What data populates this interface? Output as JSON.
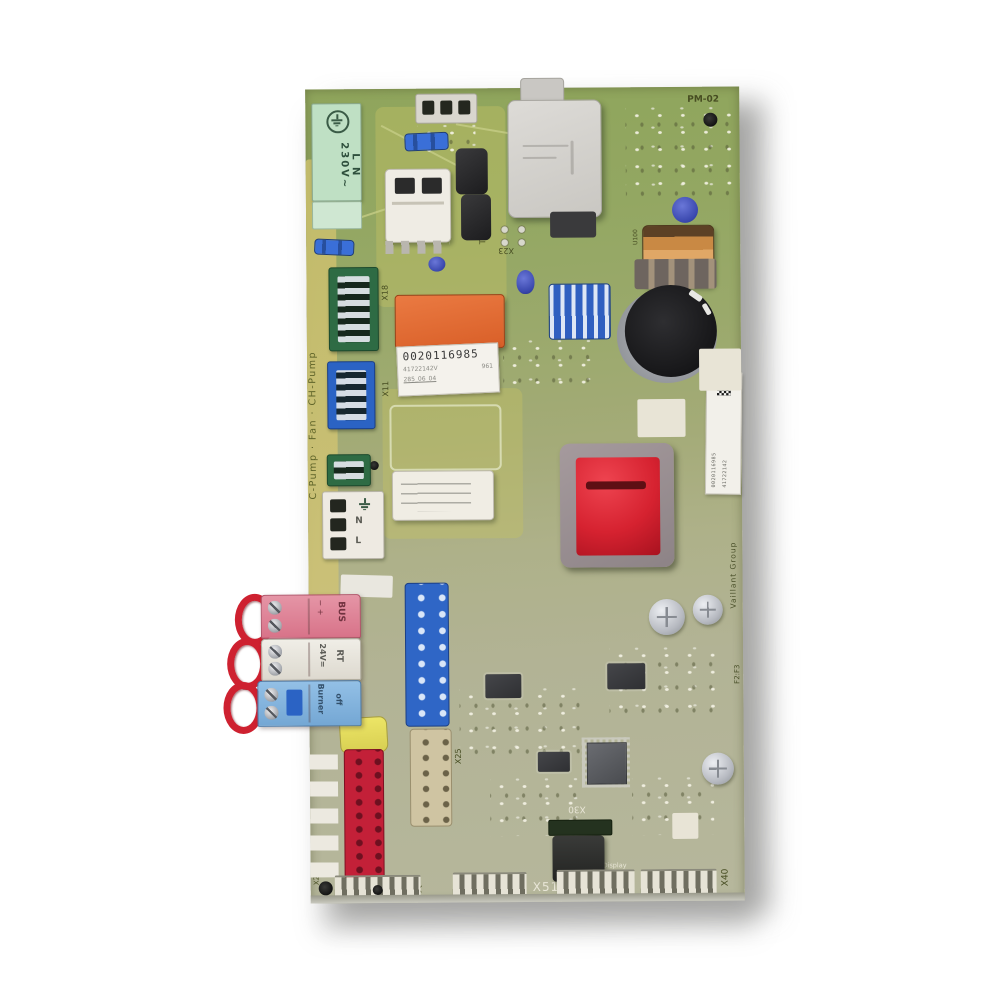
{
  "photo": {
    "subject": "Vaillant boiler control circuit board photographed on white background"
  },
  "colors": {
    "board_top": "#8fa55c",
    "board_bottom": "#b6b79c",
    "relay_orange": "#e06f38",
    "transformer_red": "#d62230",
    "connector_pink": "#e08a9b",
    "connector_blue": "#86b5de",
    "header_blue": "#2f66c6",
    "header_red": "#c32038",
    "mains_green": "#bfe0c4"
  },
  "silkscreen": {
    "pm02": "PM-02",
    "code_0914": "0914",
    "t2": "T2",
    "x23": "X23",
    "x18": "X18",
    "x11": "X11",
    "u100": "U100",
    "x25": "X25",
    "x24": "X24",
    "x21": "X21",
    "x51": "X51",
    "x30": "X30",
    "x40": "X40",
    "display": "Display",
    "vaillant": "Vaillant Group",
    "f2f3": "F2:F3",
    "left_edge": "C-Pump · Fan · CH-Pump"
  },
  "labels": {
    "product": {
      "line1": "0020116985",
      "line2_left": "41722142V",
      "line2_right": "961",
      "line3": "285_06_04"
    },
    "side": {
      "line1": "0020116985",
      "line2": "41722142"
    }
  },
  "connectors": {
    "mains": {
      "label": "L N 230V~"
    },
    "pump_terminal": {
      "n": "N",
      "l": "L"
    },
    "bus": {
      "polarity": "− +",
      "label": "BUS"
    },
    "rt": {
      "line1": "24V=",
      "line2": "RT"
    },
    "burner": {
      "line1": "Burner",
      "line2": "off"
    }
  }
}
